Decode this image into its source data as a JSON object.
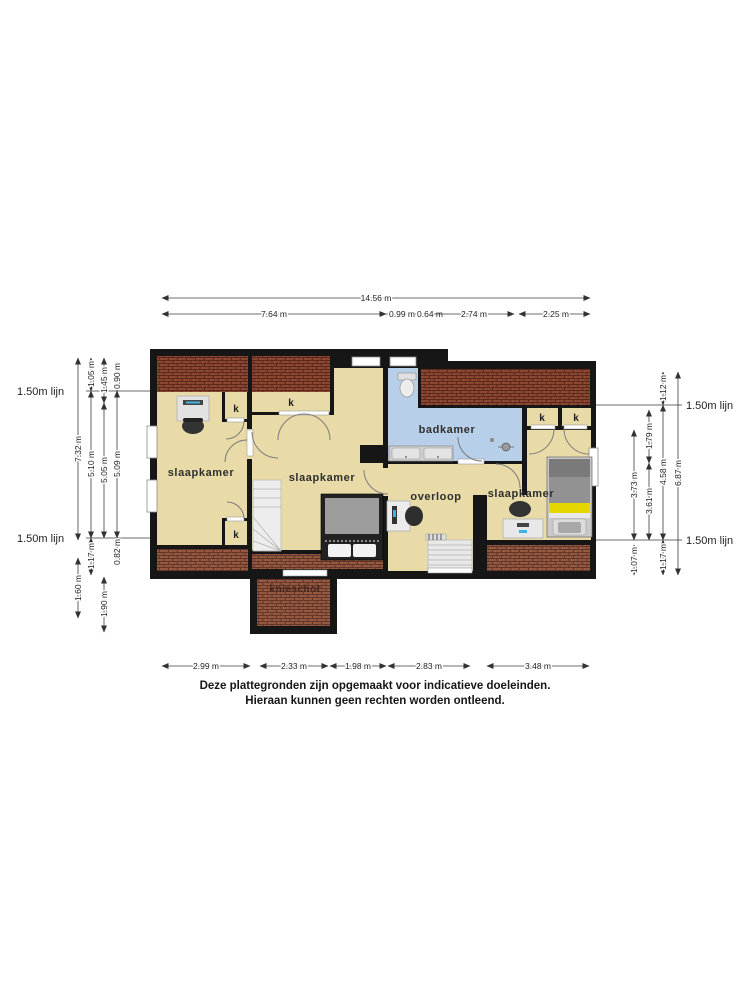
{
  "floorplan": {
    "labels": {
      "bedroom": "slaapkamer",
      "bathroom": "badkamer",
      "landing": "overloop",
      "knee_wall": "knieschot",
      "closet": "k"
    },
    "reference_line": "1.50m lijn",
    "dimensions": {
      "top_total": "14.56 m",
      "top": [
        "7.64 m",
        "0.99 m",
        "0.64 m",
        "2.74 m",
        "2.25 m"
      ],
      "bottom": [
        "2.99 m",
        "2.33 m",
        "1.98 m",
        "2.83 m",
        "3.48 m"
      ],
      "left": {
        "col1": [
          "7.32 m",
          "1.60 m"
        ],
        "col2": [
          "1.05 m",
          "5.10 m",
          "1.17 m"
        ],
        "col3": [
          "1.45 m",
          "5.05 m",
          "1.90 m"
        ],
        "col4": [
          "0.90 m",
          "5.09 m",
          "0.82 m"
        ]
      },
      "right": {
        "col1": [
          "3.73 m",
          "1.07 m"
        ],
        "col2": [
          "1.79 m",
          "3.61 m"
        ],
        "col3": [
          "1.12 m",
          "4.58 m",
          "1.17 m"
        ],
        "col4": [
          "6.87 m"
        ]
      }
    },
    "disclaimer": {
      "line1": "Deze plattegronden zijn opgemaakt voor indicatieve doeleinden.",
      "line2": "Hieraan kunnen geen rechten worden ontleend."
    },
    "colors": {
      "floor": "#e8dba7",
      "bathroom": "#b8cfe9",
      "roof_dark": "#8a4531",
      "roof_light": "#91583f",
      "wall": "#161616",
      "bed_accent_yellow": "#e6d600"
    }
  }
}
